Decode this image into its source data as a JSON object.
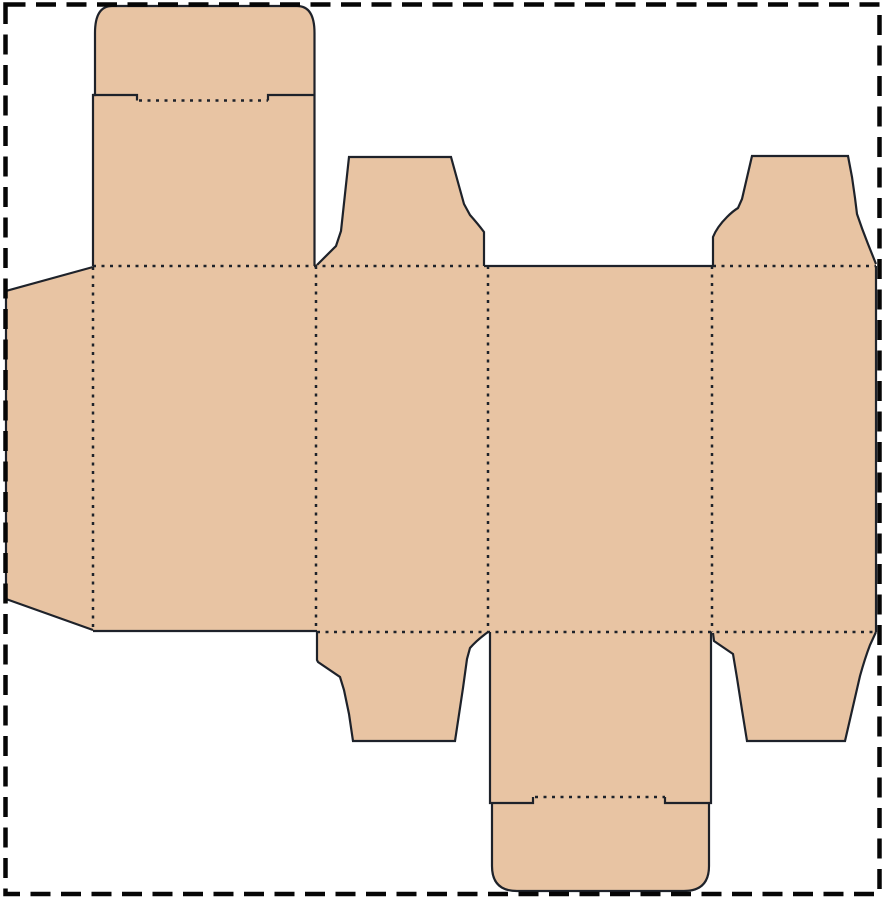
{
  "diagram": {
    "type": "packaging-dieline",
    "description": "Die-cut template (net) of a straight tuck-end folding carton: four body panels in a row with a left glue flap, a rounded tuck lid with lock slit on top of the first wide panel, a matching rounded tuck flap with lock slit under the second wide panel, and four trapezoidal dust flaps on the side panels. Solid lines are cuts, dotted lines are folds, and a heavy dashed rectangle marks the page boundary.",
    "canvas": {
      "width": 885,
      "height": 900,
      "background": "#ffffff"
    },
    "colors": {
      "board_fill": "#e8c4a3",
      "line_color": "#1e222a",
      "border_color": "#060606",
      "page_background": "#ffffff"
    },
    "paths": [
      {
        "name": "carton-silhouette",
        "style": "fill",
        "d": "M 95,33 Q 95,6 112,6 L 297,6 Q 314.5,6 314.5,33 L 314.5,264 L 317,264 L 336,246 L 341,231 L 349,157 L 451,157 L 459,186 L 464,204 L 470,215 Q 478,224 484,232 L 484,265 L 713,265 L 713,237 Q 717,227 727,217 Q 733,211 738,208 L 742,199 L 752,156 L 848,156 L 852,177 L 855,198 L 857,214 Q 862,229 868,244 L 876,263 L 876,632 L 870,645 Q 865,658 860,676 L 845,741 L 747,741 L 742,710 L 737,678 L 733,654 L 714,641 L 713,634 L 711,632 L 711,803 L 709,803 L 709,866 Q 709,891 684,891 L 517,891 Q 492,891 492,866 L 492,803 L 490,803 L 490,632 L 488,632 Q 477,640 470,648 L 467,659 L 463,688 L 455,741 L 353,741 L 349,714 L 344,690 L 340,677 L 318,662 L 317,660 L 317,631 L 93,631 L 6,599 L 6,291 L 93,267 L 93,95 L 95,95 Z"
      },
      {
        "name": "tuck-lid-cut-edge",
        "style": "cut",
        "d": "M 93,266 L 93,95 L 95,95 L 95,33 Q 95,6 112,6 L 297,6 Q 314.5,6 314.5,33 L 314.5,266"
      },
      {
        "name": "tuck-lid-lock-slit-left-cut",
        "style": "cut",
        "d": "M 93,95 L 137,95 L 137,100.5"
      },
      {
        "name": "tuck-lid-lock-slit-right-cut",
        "style": "cut",
        "d": "M 268,100.5 L 268,95 L 314.5,95"
      },
      {
        "name": "top-dust-flap-left-cut-edge",
        "style": "cut",
        "d": "M 317,265 L 336,246 L 341,231 L 349,157 L 451,157 L 459,186 L 464,204 L 470,215 Q 478,224 484,232 L 484,266"
      },
      {
        "name": "back-panel-top-cut-edge",
        "style": "cut",
        "d": "M 484,266 L 713,266"
      },
      {
        "name": "top-dust-flap-right-cut-edge",
        "style": "cut",
        "d": "M 713,266 L 713,237 Q 717,227 727,217 Q 733,211 738,208 L 742,199 L 752,156 L 848,156 L 852,177 L 855,198 L 857,214 Q 862,229 868,244 L 876,264"
      },
      {
        "name": "right-side-panel-cut-edge",
        "style": "cut",
        "d": "M 876,266 L 876,632"
      },
      {
        "name": "bottom-dust-flap-right-cut-edge",
        "style": "cut",
        "d": "M 876,632 L 870,645 Q 865,658 860,676 L 845,741 L 747,741 L 742,710 L 737,678 L 733,654 L 714,641 L 713,633"
      },
      {
        "name": "bottom-tuck-right-cut-edge",
        "style": "cut",
        "d": "M 711,632 L 711,803 L 665,803 L 665,797"
      },
      {
        "name": "bottom-tuck-left-cut-edge",
        "style": "cut",
        "d": "M 490,632 L 490,803 L 533,803 L 533,797"
      },
      {
        "name": "bottom-tuck-rounded-end-cut-edge",
        "style": "cut",
        "d": "M 492,803 L 492,866 Q 492,891 517,891 L 684,891 Q 709,891 709,866 L 709,803"
      },
      {
        "name": "bottom-dust-flap-left-cut-edge",
        "style": "cut",
        "d": "M 488,632 Q 477,640 470,648 L 467,659 L 463,688 L 455,741 L 353,741 L 349,714 L 344,690 L 340,677 L 318,662 L 317,660 L 317,632"
      },
      {
        "name": "front-panel-bottom-cut-edge",
        "style": "cut",
        "d": "M 93,631 L 317,631"
      },
      {
        "name": "glue-flap-cut-edge",
        "style": "cut",
        "d": "M 93,267 L 6,291 L 6,599 L 93,630"
      },
      {
        "name": "top-fold-line-left",
        "style": "fold",
        "d": "M 93,266 L 484,266"
      },
      {
        "name": "top-fold-line-right",
        "style": "fold",
        "d": "M 713,266 L 876,266"
      },
      {
        "name": "bottom-fold-line",
        "style": "fold",
        "d": "M 317,632 L 876,632"
      },
      {
        "name": "glue-flap-fold-line",
        "style": "fold",
        "d": "M 93,267 L 93,630"
      },
      {
        "name": "panel-fold-line-1",
        "style": "fold",
        "d": "M 316,266 L 316,632"
      },
      {
        "name": "panel-fold-line-2",
        "style": "fold",
        "d": "M 488,266 L 488,632"
      },
      {
        "name": "panel-fold-line-3",
        "style": "fold",
        "d": "M 712,266 L 712,632"
      },
      {
        "name": "tuck-lid-slit-fold-line",
        "style": "fold",
        "d": "M 139,100.5 L 268,100.5"
      },
      {
        "name": "bottom-tuck-slit-fold-line",
        "style": "fold",
        "d": "M 535,797 L 665,797"
      },
      {
        "name": "page-border-dashed",
        "style": "border",
        "d": "M 5.5,4.5 L 879.5,4.5 L 879.5,894 L 5.5,894 Z"
      }
    ]
  }
}
